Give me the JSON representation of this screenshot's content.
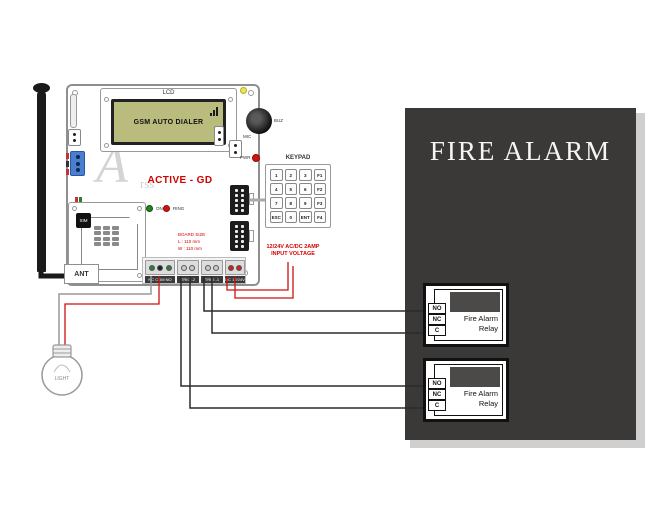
{
  "panel": {
    "title": "FIRE ALARM"
  },
  "board": {
    "lcd_label": "LCD",
    "lcd_text": "GSM AUTO DIALER",
    "model": "ACTIVE - GD",
    "watermark": {
      "big": "A",
      "small": "rss"
    },
    "buzzer_label": "BUZ",
    "mic_label": "MIC",
    "pwr_label": "PWR",
    "sim_label": "SIM",
    "ant_label": "ANT",
    "leds": [
      {
        "label": "ON"
      },
      {
        "label": "RING"
      }
    ],
    "size_lines": [
      "BOARD SIZE",
      "L : 110 mm",
      "W : 110 mm"
    ],
    "terminals": [
      "NC COM NO",
      "TRIG -2",
      "TRIG -1",
      "DC 12/24V"
    ]
  },
  "keypad": {
    "label": "KEYPAD",
    "keys": [
      "1",
      "2",
      "3",
      "F1",
      "4",
      "5",
      "6",
      "F2",
      "7",
      "8",
      "9",
      "F3",
      "ESC",
      "0",
      "ENT",
      "F4"
    ]
  },
  "power_note": {
    "line1": "12/24V AC/DC 2AMP",
    "line2": "INPUT VOLTAGE"
  },
  "relays": [
    {
      "line1": "Fire Alarm",
      "line2": "Relay",
      "terminals": [
        "NO",
        "NC",
        "C"
      ]
    },
    {
      "line1": "Fire Alarm",
      "line2": "Relay",
      "terminals": [
        "NO",
        "NC",
        "C"
      ]
    }
  ],
  "light": {
    "label": "LIGHT"
  },
  "colors": {
    "panel_bg": "#3b3938",
    "lcd_green": "#b9bc7c",
    "accent_red": "#d40000",
    "wire_red": "#cc1111",
    "wire_black": "#2b2b2b",
    "led_green": "#1e8a1e",
    "led_red": "#d41111",
    "led_yellow": "#ece84a"
  }
}
